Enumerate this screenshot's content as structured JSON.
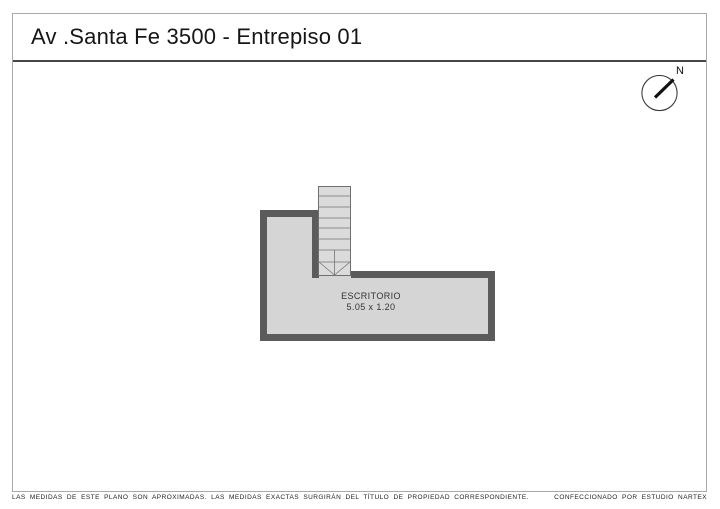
{
  "page": {
    "title": "Av .Santa Fe 3500 - Entrepiso 01"
  },
  "compass": {
    "north_label": "N"
  },
  "floor_plan": {
    "room": {
      "label": "ESCRITORIO",
      "dimensions": "5.05 x 1.20"
    },
    "features": {
      "stairs": "staircase-with-down-arrow"
    }
  },
  "footer": {
    "disclaimer": "LAS MEDIDAS  DE ESTE PLANO SON APROXIMADAS. LAS MEDIDAS EXACTAS SURGIRÁN DEL TÍTULO DE PROPIEDAD CORRESPONDIENTE.",
    "credit": "CONFECCIONADO POR ESTUDIO NARTEX"
  },
  "colors": {
    "wall": "#5b5b5b",
    "floor": "#d5d5d5",
    "stairs_fill": "#dbdbdb",
    "stairs_line": "#757575",
    "frame_border": "#a9a9a9",
    "title_separator": "#474747"
  }
}
